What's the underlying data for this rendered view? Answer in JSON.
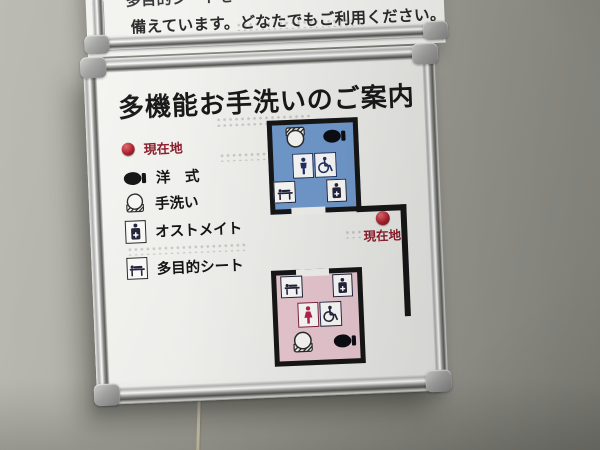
{
  "upper_sign": {
    "line1_partial": "多目的シートを",
    "line2": "備えています。どなたでもご利用ください。"
  },
  "main_sign": {
    "title": "多機能お手洗いのご案内",
    "legend": {
      "items": [
        {
          "label": "現在地",
          "icon": "current-location-dot",
          "color": "#8c1e2e"
        },
        {
          "label": "洋　式",
          "icon": "western-toilet-icon"
        },
        {
          "label": "手洗い",
          "icon": "sink-icon"
        },
        {
          "label": "オストメイト",
          "icon": "ostomate-icon"
        },
        {
          "label": "多目的シート",
          "icon": "multipurpose-sheet-icon"
        }
      ]
    },
    "map": {
      "current_location_label": "現在地",
      "rooms": [
        {
          "name": "mens-multifunction-restroom",
          "fill": "#6f98ca",
          "facilities": [
            "sink",
            "western-toilet",
            "male",
            "wheelchair",
            "multipurpose-sheet",
            "ostomate"
          ]
        },
        {
          "name": "womens-multifunction-restroom",
          "fill": "#e5c5ce",
          "facilities": [
            "multipurpose-sheet",
            "ostomate",
            "female",
            "wheelchair",
            "sink",
            "western-toilet"
          ]
        }
      ]
    }
  },
  "colors": {
    "accent_red": "#8c1e2e",
    "room_blue": "#6f98ca",
    "room_pink": "#e5c5ce",
    "wall_line_black": "#161616",
    "board_white": "#f1f1ee",
    "frame_silver": "#b5b5b3",
    "wall_gray": "#a0a098",
    "pictogram_navy": "#203066",
    "pictogram_crimson": "#b5234a"
  }
}
